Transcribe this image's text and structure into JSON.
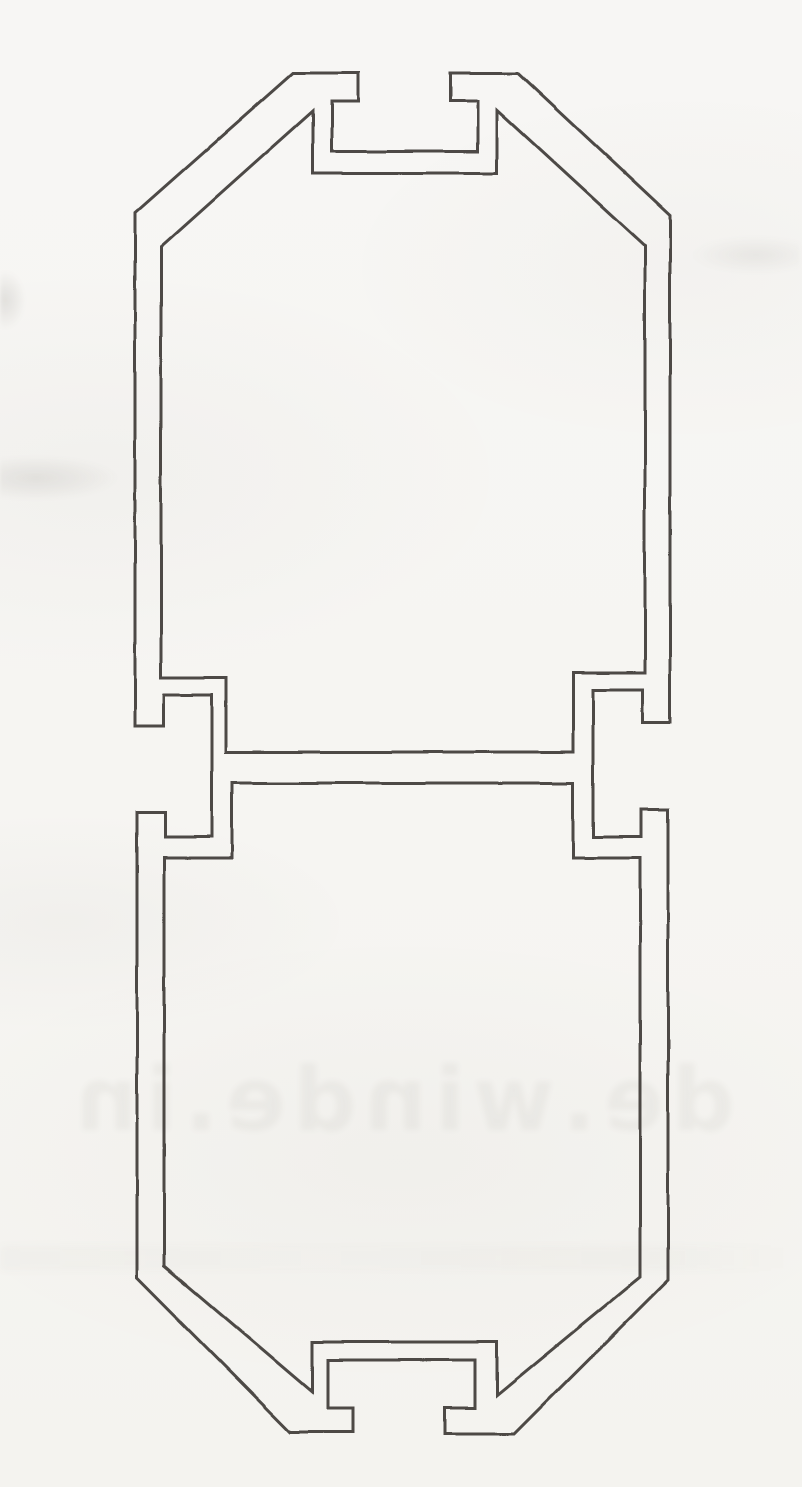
{
  "page": {
    "width": 802,
    "height": 1487,
    "paper_color": "#f6f5f2",
    "kind": "scanned catalog page, line drawing only, no visible dimension labels"
  },
  "watermark": {
    "text": "de.winde.in",
    "opacity": 0.05,
    "note": "faint mirrored ink bleed-through from reverse side of page"
  },
  "drawing": {
    "subject": "aluminium-extrusion-profile-cross-section",
    "description": "Elongated octagonal hollow profile: two chambers joined by a central horizontal web; T-slot channels on top and bottom faces; C-shaped accessory channels opening outward on left and right at web level; 45-degree chamfered corners",
    "ink_color": "#34322f",
    "stroke_width": 3,
    "loops": {
      "outer": [
        [
          293,
          73
        ],
        [
          358,
          73
        ],
        [
          358,
          101
        ],
        [
          332,
          101
        ],
        [
          332,
          151
        ],
        [
          478,
          151
        ],
        [
          478,
          101
        ],
        [
          450,
          101
        ],
        [
          450,
          73
        ],
        [
          518,
          73
        ],
        [
          670,
          215
        ],
        [
          670,
          722
        ],
        [
          643,
          722
        ],
        [
          643,
          690
        ],
        [
          593,
          690
        ],
        [
          593,
          837
        ],
        [
          641,
          837
        ],
        [
          641,
          810
        ],
        [
          668,
          810
        ],
        [
          668,
          1280
        ],
        [
          514,
          1434
        ],
        [
          445,
          1434
        ],
        [
          445,
          1408
        ],
        [
          475,
          1408
        ],
        [
          475,
          1360
        ],
        [
          328,
          1360
        ],
        [
          328,
          1408
        ],
        [
          353,
          1408
        ],
        [
          353,
          1432
        ],
        [
          290,
          1432
        ],
        [
          137,
          1278
        ],
        [
          137,
          812
        ],
        [
          165,
          812
        ],
        [
          165,
          837
        ],
        [
          212,
          837
        ],
        [
          212,
          695
        ],
        [
          164,
          695
        ],
        [
          164,
          726
        ],
        [
          135,
          726
        ],
        [
          135,
          213
        ]
      ],
      "upper_chamber": [
        [
          313,
          111
        ],
        [
          313,
          173
        ],
        [
          497,
          173
        ],
        [
          497,
          110
        ],
        [
          645,
          246
        ],
        [
          645,
          673
        ],
        [
          573,
          673
        ],
        [
          573,
          752
        ],
        [
          226,
          752
        ],
        [
          226,
          678
        ],
        [
          161,
          678
        ],
        [
          161,
          247
        ]
      ],
      "lower_chamber": [
        [
          232,
          783
        ],
        [
          573,
          783
        ],
        [
          573,
          858
        ],
        [
          640,
          858
        ],
        [
          640,
          1277
        ],
        [
          497,
          1395
        ],
        [
          497,
          1342
        ],
        [
          312,
          1342
        ],
        [
          312,
          1392
        ],
        [
          164,
          1266
        ],
        [
          164,
          858
        ],
        [
          232,
          858
        ]
      ]
    }
  }
}
